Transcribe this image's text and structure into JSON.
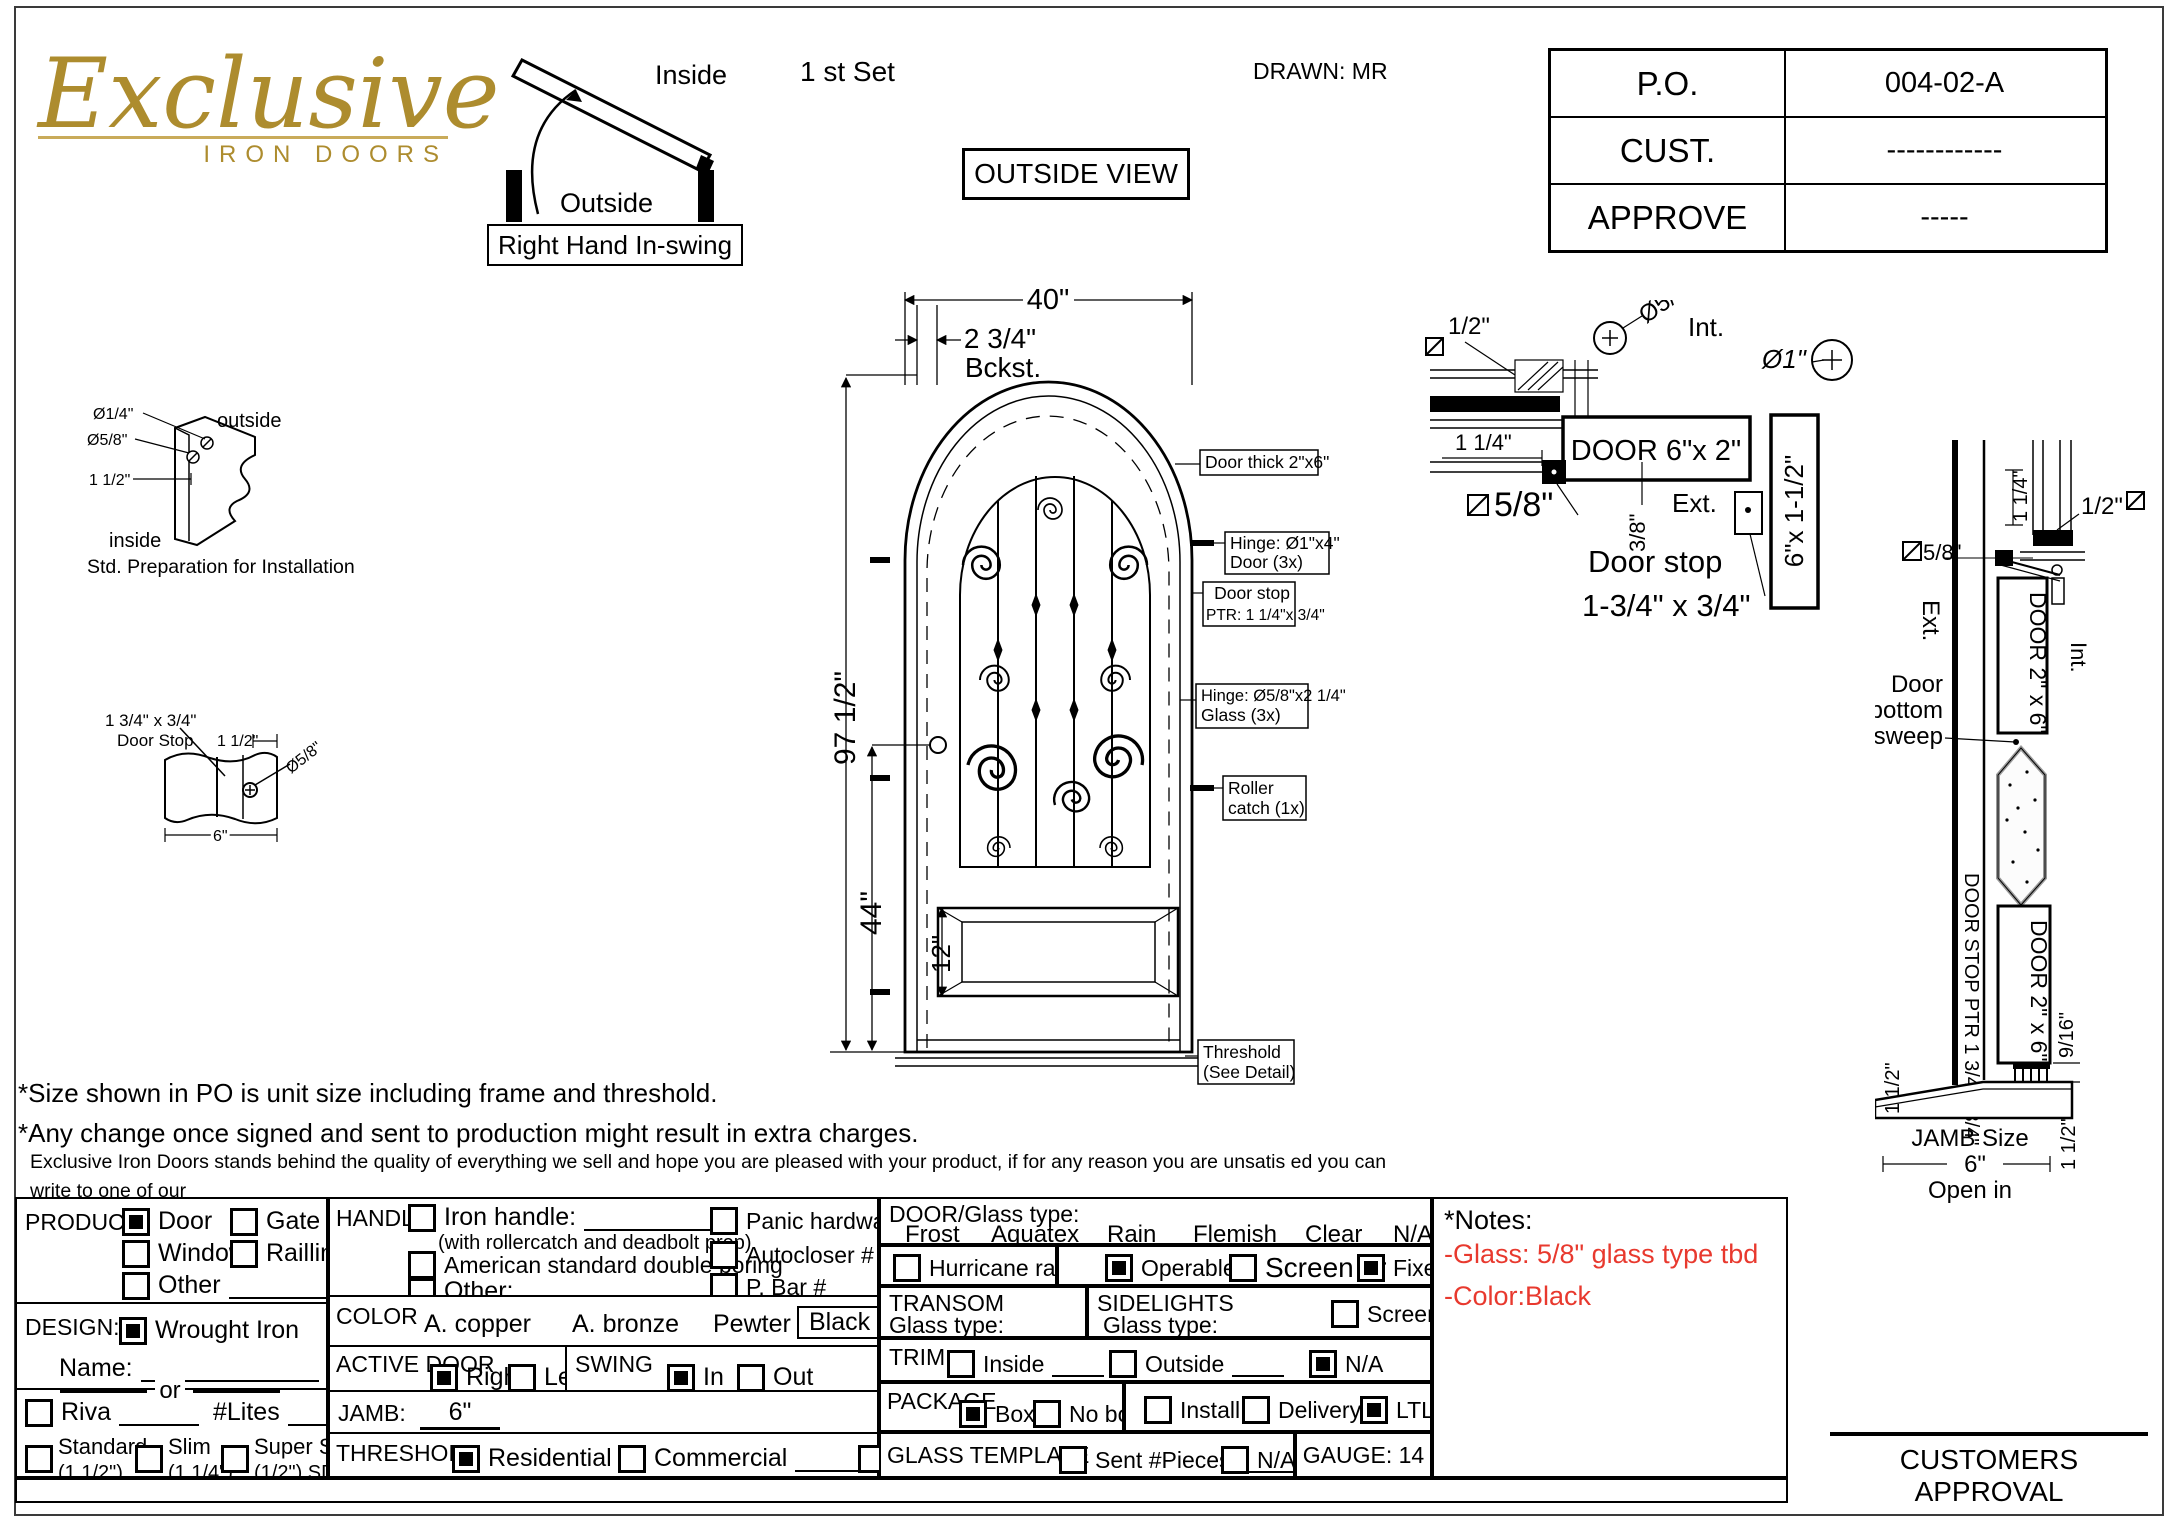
{
  "header": {
    "logo_name": "Exclusive",
    "logo_sub": "IRON DOORS",
    "set_label": "1 st Set",
    "outside_view": "OUTSIDE VIEW",
    "drawn": "DRAWN: MR"
  },
  "swing_diag": {
    "inside": "Inside",
    "outside": "Outside",
    "caption": "Right Hand In-swing"
  },
  "po_table": {
    "rows": [
      {
        "label": "P.O.",
        "value": "004-02-A"
      },
      {
        "label": "CUST.",
        "value": "------------"
      },
      {
        "label": "APPROVE",
        "value": "-----"
      }
    ]
  },
  "std_prep": {
    "d1": "Ø1/4\"",
    "d2": "Ø5/8\"",
    "d3": "1 1/2\"",
    "outside": "outside",
    "inside": "inside",
    "caption": "Std. Preparation for Installation"
  },
  "stop_detail": {
    "l1": "1 3/4\" x 3/4\"",
    "l2": "Door Stop",
    "d1": "1 1/2\"",
    "d2": "Ø5/8\"",
    "d3": "6\""
  },
  "elevation": {
    "dim_width": "40\"",
    "dim_backset": "2 3/4\"",
    "backset_label": "Bckst.",
    "dim_height": "97 1/2\"",
    "dim_mid": "44\"",
    "dim_panel": "12\"",
    "callouts": {
      "thick": {
        "l1": "Door thick 2\"x6\""
      },
      "hinge_door": {
        "l1": "Hinge: Ø1\"x4\"",
        "l2": "Door (3x)"
      },
      "door_stop": {
        "l1": "Door stop",
        "l2": "PTR: 1 1/4\"x 3/4\""
      },
      "hinge_glass": {
        "l1": "Hinge: Ø5/8\"x2 1/4\"",
        "l2": "Glass (3x)"
      },
      "roller": {
        "l1": "Roller",
        "l2": "catch  (1x)"
      },
      "threshold": {
        "l1": "Threshold",
        "l2": "(See Detail)"
      }
    }
  },
  "head_detail": {
    "half": "1/2\"",
    "int": "Int.",
    "d58": "Ø5/8\"",
    "d1": "Ø1\"",
    "dim114": "1 1/4\"",
    "door62": "DOOR 6\"x 2\"",
    "jamb6x15": "6\"x 1-1/2\"",
    "f58": "5/8\"",
    "f38": "3/8\"",
    "ext": "Ext.",
    "stop1": "Door stop",
    "stop2": "1-3/4\" x 3/4\""
  },
  "sill_section": {
    "dim114": "1 1/4\"",
    "half": "1/2\"",
    "f58": "5/8\"",
    "ext": "Ext.",
    "int": "Int.",
    "door26_a": "DOOR 2\" x 6\"",
    "door26_b": "DOOR 2\" x 6\"",
    "sweep1": "Door",
    "sweep2": "bottom",
    "sweep3": "sweep",
    "stop_ptr": "DOOR STOP PTR 1 3/4\"x 3/4\"",
    "dim916": "9/16\"",
    "dim112_l": "1 1/2\"",
    "dim112_r": "1 1/2\"",
    "jamb1": "JAMB Size",
    "jamb2": "6\"",
    "open_in": "Open in"
  },
  "notes": {
    "n1": "*Size shown in PO is unit size including frame and threshold.",
    "n2": "*Any change once signed and sent to production might result in extra charges.",
    "p1": "Exclusive Iron Doors stands behind the quality of everything we sell and hope you are pleased with your product, if for any reason you are unsatis   ed you can write to one of our",
    "p2": "representatives to verify your situation and determine how can we help you, but we do not accept returns in any of our products.Products are    nal and are not eligible for returns, changes",
    "p3": "or alterations.By signing you agree to our terms and conditions, delivery pdf and forms of payment. *Doors measurements do not include the gaps between jambs"
  },
  "form": {
    "product": {
      "label": "PRODUCT:",
      "door": {
        "label": "Door",
        "checked": true
      },
      "gate": {
        "label": "Gate",
        "checked": false
      },
      "window": {
        "label": "Window",
        "checked": false
      },
      "railling": {
        "label": "Railling",
        "checked": false
      },
      "other": {
        "label": "Other",
        "checked": false
      }
    },
    "design": {
      "label": "DESIGN:",
      "wrought": {
        "label": "Wrought Iron",
        "checked": true
      },
      "name_label": "Name:",
      "or": "or",
      "riva": {
        "label": "Riva",
        "checked": false
      },
      "lites": "#Lites",
      "standard": {
        "label": "Standard",
        "sub": "(1 1/2\")",
        "checked": false
      },
      "slim": {
        "label": "Slim",
        "sub": "(1 1/4\")",
        "checked": false
      },
      "super_slim": {
        "label": "Super Slim",
        "sub": "(1/2\") SDL",
        "checked": false
      }
    },
    "handle": {
      "label": "HANDLE",
      "iron": {
        "label": "Iron handle:",
        "sub": "(with rollercatch and deadbolt prep)",
        "checked": false
      },
      "american": {
        "label": "American standard double boring",
        "checked": false
      },
      "other": {
        "label": "Other:",
        "checked": false
      },
      "panic": {
        "label": "Panic hardware",
        "checked": false
      },
      "autocloser": {
        "label": "Autocloser #",
        "checked": false
      },
      "pbar": {
        "label": "P. Bar #",
        "checked": false
      }
    },
    "color": {
      "label": "COLOR",
      "copper": "A. copper",
      "bronze": "A. bronze",
      "pewter": "Pewter",
      "black": "Black",
      "selected": "Black",
      "see_notes": "See notes*"
    },
    "active_door": {
      "label": "ACTIVE DOOR",
      "right": {
        "label": "Right",
        "checked": true
      },
      "left": {
        "label": "Left",
        "checked": false
      }
    },
    "swing": {
      "label": "SWING",
      "in": {
        "label": "In",
        "checked": true
      },
      "out": {
        "label": "Out",
        "checked": false
      }
    },
    "jamb": {
      "label": "JAMB:",
      "value": "6\""
    },
    "threshold": {
      "label": "THRESHOLD",
      "residential": {
        "label": "Residential",
        "checked": true
      },
      "commercial": {
        "label": "Commercial",
        "checked": false
      },
      "na": {
        "label": "N/A",
        "checked": false
      }
    },
    "door_glass": {
      "label": "DOOR/Glass type:",
      "types": [
        "Frost",
        "Aquatex",
        "Rain",
        "Flemish",
        "Clear",
        "N/A"
      ],
      "hurricane": {
        "label": "Hurricane rated",
        "checked": false
      },
      "operable": {
        "label": "Operable",
        "checked": true
      },
      "screen_or": {
        "label": "Screen or",
        "checked": false
      },
      "fixed": {
        "label": "Fixed",
        "checked": true
      }
    },
    "transom": {
      "label": "TRANSOM",
      "glass": "Glass type:"
    },
    "sidelights": {
      "label": "SIDELIGHTS",
      "glass": "Glass type:",
      "screen": {
        "label": "Screen",
        "checked": false
      }
    },
    "trim": {
      "label": "TRIM",
      "inside": {
        "label": "Inside",
        "checked": false
      },
      "outside": {
        "label": "Outside",
        "checked": false
      },
      "na": {
        "label": "N/A",
        "checked": true
      }
    },
    "package": {
      "label": "PACKAGE",
      "box": {
        "label": "Box",
        "checked": true
      },
      "no_box": {
        "label": "No box",
        "checked": false
      },
      "install": {
        "label": "Install",
        "checked": false
      },
      "delivery": {
        "label": "Delivery",
        "checked": false
      },
      "ltl": {
        "label": "LTL",
        "checked": true
      }
    },
    "glass_template": {
      "label": "GLASS TEMPLATE",
      "sent": {
        "label": "Sent #Pieces",
        "checked": false
      },
      "na": {
        "label": "N/A",
        "checked": false
      }
    },
    "gauge": "GAUGE: 14",
    "notes_box": {
      "title": "*Notes:",
      "glass_note": "-Glass: 5/8\" glass type tbd",
      "color_note": "-Color:Black"
    }
  },
  "approval": "CUSTOMERS APPROVAL",
  "colors": {
    "gold": "#ad8c2e",
    "note_red": "#e8392e",
    "line": "#000000"
  }
}
